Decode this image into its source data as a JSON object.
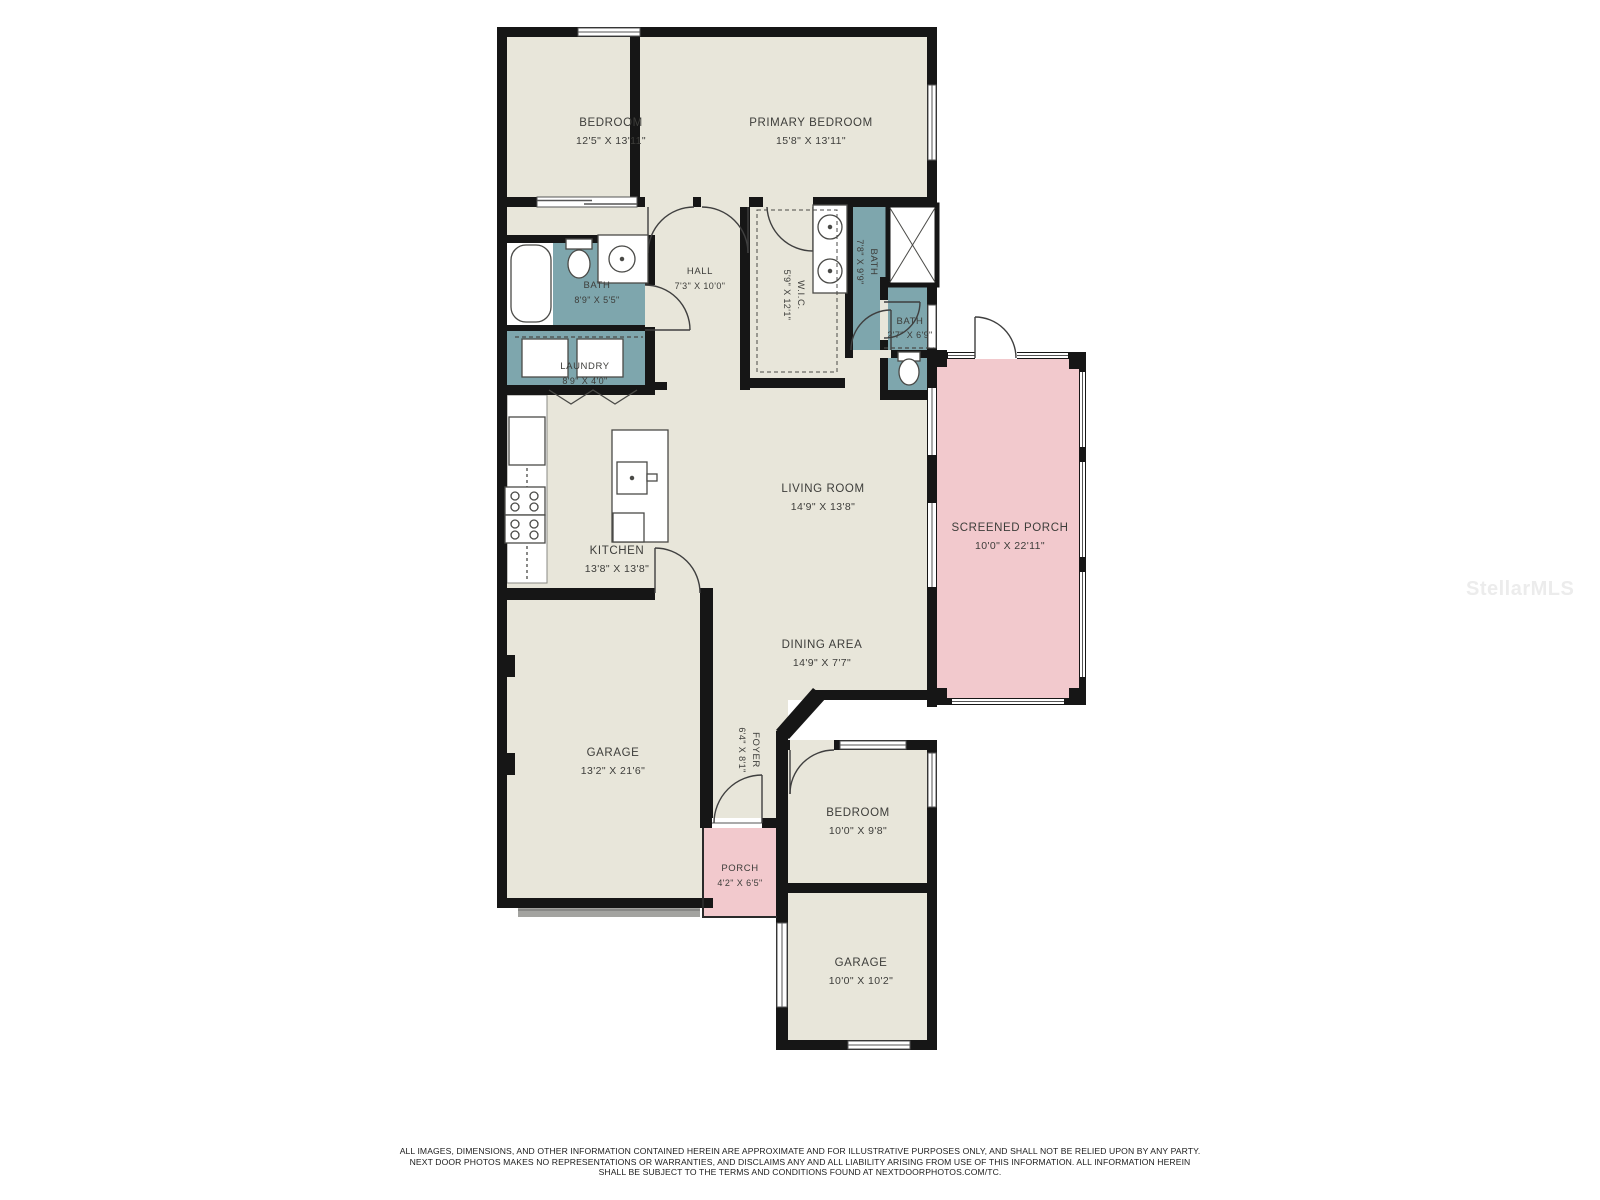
{
  "watermark": "StellarMLS",
  "rooms": {
    "bedroom1": {
      "name": "BEDROOM",
      "dims": "12'5\" X 13'11\""
    },
    "primary": {
      "name": "PRIMARY BEDROOM",
      "dims": "15'8\" X 13'11\""
    },
    "bath1": {
      "name": "BATH",
      "dims": "8'9\" X 5'5\""
    },
    "hall": {
      "name": "HALL",
      "dims": "7'3\" X 10'0\""
    },
    "laundry": {
      "name": "LAUNDRY",
      "dims": "8'9\" X 4'0\""
    },
    "wic": {
      "name": "W.I.C.",
      "dims": "5'9\" X 12'1\""
    },
    "bath2": {
      "name": "BATH",
      "dims": "7'8\" X 9'9\""
    },
    "bath3": {
      "name": "BATH",
      "dims": "2'7\" X 6'9\""
    },
    "living": {
      "name": "LIVING ROOM",
      "dims": "14'9\" X 13'8\""
    },
    "kitchen": {
      "name": "KITCHEN",
      "dims": "13'8\" X 13'8\""
    },
    "screenedPorch": {
      "name": "SCREENED PORCH",
      "dims": "10'0\" X 22'11\""
    },
    "dining": {
      "name": "DINING AREA",
      "dims": "14'9\" X 7'7\""
    },
    "garage1": {
      "name": "GARAGE",
      "dims": "13'2\" X 21'6\""
    },
    "foyer": {
      "name": "FOYER",
      "dims": "6'4\" X 8'1\""
    },
    "porch": {
      "name": "PORCH",
      "dims": "4'2\" X 6'5\""
    },
    "bedroom2": {
      "name": "BEDROOM",
      "dims": "10'0\" X 9'8\""
    },
    "garage2": {
      "name": "GARAGE",
      "dims": "10'0\" X 10'2\""
    }
  },
  "colors": {
    "room": "#e8e6da",
    "wet": "#7ea6ad",
    "porch": "#f2c9cd",
    "wall": "#161616"
  },
  "disclaimer": {
    "line1": "ALL IMAGES, DIMENSIONS, AND OTHER INFORMATION CONTAINED HEREIN ARE APPROXIMATE AND FOR ILLUSTRATIVE PURPOSES ONLY, AND SHALL NOT BE RELIED UPON BY ANY PARTY.",
    "line2": "NEXT DOOR PHOTOS MAKES NO REPRESENTATIONS OR WARRANTIES, AND DISCLAIMS ANY AND ALL LIABILITY ARISING FROM USE OF THIS INFORMATION. ALL INFORMATION HEREIN",
    "line3": "SHALL BE SUBJECT TO THE TERMS AND CONDITIONS FOUND AT NEXTDOORPHOTOS.COM/TC."
  }
}
